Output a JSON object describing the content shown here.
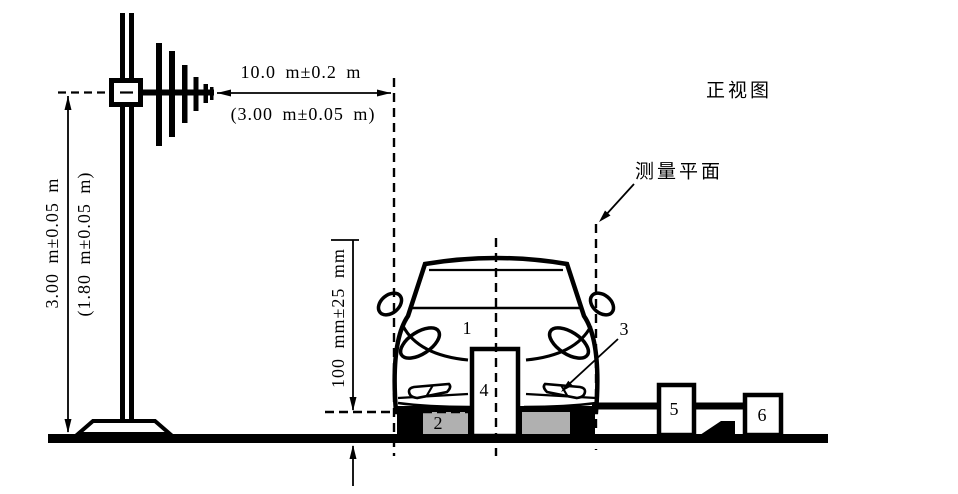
{
  "diagram": {
    "view_label": "正视图",
    "measurement_plane_label": "测量平面",
    "dimensions": {
      "antenna_distance": "10.0 m±0.2 m",
      "antenna_distance_alt": "(3.00 m±0.05 m)",
      "antenna_height": "3.00 m±0.05 m",
      "antenna_height_alt": "(1.80 m±0.05 m)",
      "ground_clearance": "100 mm±25 mm"
    },
    "callouts": [
      {
        "id": "1"
      },
      {
        "id": "2"
      },
      {
        "id": "3"
      },
      {
        "id": "4"
      },
      {
        "id": "5"
      },
      {
        "id": "6"
      }
    ]
  },
  "colors": {
    "line": "#000000",
    "support_fill": "#b0b0b0",
    "background": "#ffffff"
  }
}
